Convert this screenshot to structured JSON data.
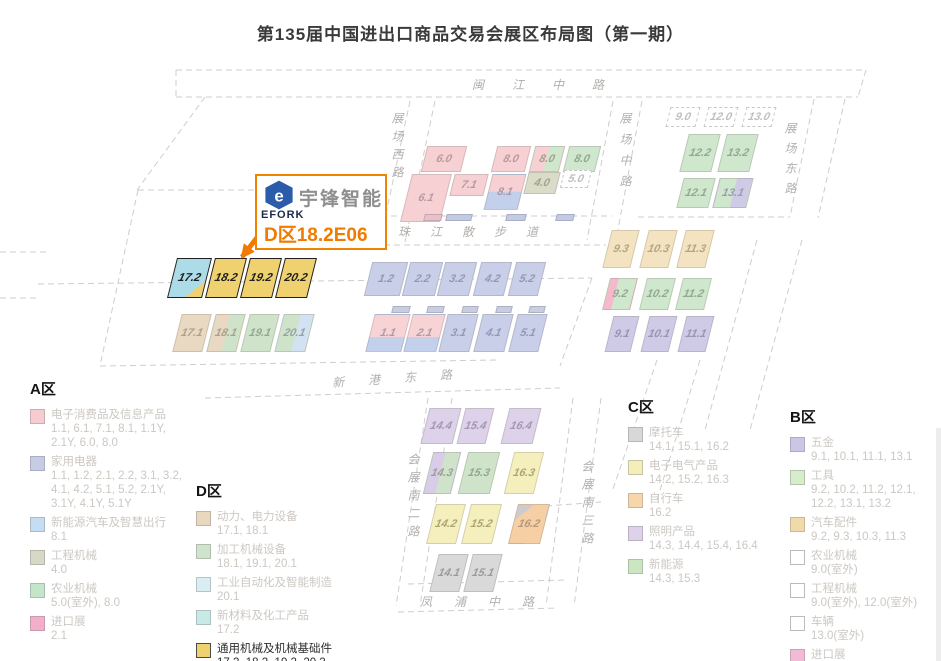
{
  "title": "第135届中国进出口商品交易会展区布局图（第一期）",
  "colors": {
    "accent_orange": "#f08300",
    "booth_text_orange": "#f07b00",
    "efork_blue": "#2a5caa",
    "highlight_yellow": "#f0d170",
    "highlight_cyan": "#abdce8",
    "dashed_road_gray": "#cdcdcd"
  },
  "callout": {
    "brand": "宇锋智能",
    "brand_sub": "EFORK",
    "booth": "D区18.2E06"
  },
  "roads": {
    "minjiang": "闽江中路",
    "west": "展场西路",
    "mid": "展场中路",
    "east": "展场东路",
    "zhujiang": "珠江散步道",
    "xingang": "新港东路",
    "south2": "会展南二路",
    "south3": "会展南三路",
    "fengpu": "凤浦中路"
  },
  "halls": {
    "h1_1": "1.1",
    "h1_2": "1.2",
    "h2_1": "2.1",
    "h2_2": "2.2",
    "h3_1": "3.1",
    "h3_2": "3.2",
    "h4_0": "4.0",
    "h4_1": "4.1",
    "h4_2": "4.2",
    "h5_0": "5.0",
    "h5_1": "5.1",
    "h5_2": "5.2",
    "h6_0": "6.0",
    "h6_1": "6.1",
    "h7_1": "7.1",
    "h8_0": "8.0",
    "h8_1": "8.1",
    "h9_0": "9.0",
    "h9_1": "9.1",
    "h9_2": "9.2",
    "h9_3": "9.3",
    "h10_1": "10.1",
    "h10_2": "10.2",
    "h10_3": "10.3",
    "h11_1": "11.1",
    "h11_2": "11.2",
    "h11_3": "11.3",
    "h12_0": "12.0",
    "h12_1": "12.1",
    "h12_2": "12.2",
    "h13_0": "13.0",
    "h13_1": "13.1",
    "h13_2": "13.2",
    "h14_1": "14.1",
    "h14_2": "14.2",
    "h14_3": "14.3",
    "h14_4": "14.4",
    "h15_1": "15.1",
    "h15_2": "15.2",
    "h15_3": "15.3",
    "h15_4": "15.4",
    "h16_2": "16.2",
    "h16_3": "16.3",
    "h16_4": "16.4",
    "h17_1": "17.1",
    "h17_2": "17.2",
    "h18_1": "18.1",
    "h18_2": "18.2",
    "h19_1": "19.1",
    "h19_2": "19.2",
    "h20_1": "20.1",
    "h20_2": "20.2"
  },
  "legends": {
    "a": {
      "title": "A区",
      "items": [
        {
          "name": "电子消费品及信息产品",
          "halls": "1.1, 6.1, 7.1, 8.1, 1.1Y, 2.1Y, 6.0, 8.0",
          "color": "#f6ccd0"
        },
        {
          "name": "家用电器",
          "halls": "1.1, 1.2, 2.1, 2.2, 3.1, 3.2, 4.1, 4.2, 5.1, 5.2, 2.1Y, 3.1Y, 4.1Y, 5.1Y",
          "color": "#c6cbe6"
        },
        {
          "name": "新能源汽车及智慧出行",
          "halls": "8.1",
          "color": "#c5ddf2"
        },
        {
          "name": "工程机械",
          "halls": "4.0",
          "color": "#d8d8c6"
        },
        {
          "name": "农业机械",
          "halls": "5.0(室外), 8.0",
          "color": "#c3e6ca"
        },
        {
          "name": "进口展",
          "halls": "2.1",
          "color": "#f3aecb"
        }
      ]
    },
    "d": {
      "title": "D区",
      "items": [
        {
          "name": "动力、电力设备",
          "halls": "17.1, 18.1",
          "color": "#e9d8be"
        },
        {
          "name": "加工机械设备",
          "halls": "18.1, 19.1, 20.1",
          "color": "#cfe4cd"
        },
        {
          "name": "工业自动化及智能制造",
          "halls": "20.1",
          "color": "#d8eef2"
        },
        {
          "name": "新材料及化工产品",
          "halls": "17.2",
          "color": "#c9e9e9"
        },
        {
          "name": "通用机械及机械基础件",
          "halls": "17.2, 18.2, 19.2, 20.2",
          "color": "#f0d170",
          "highlight": true
        }
      ]
    },
    "c": {
      "title": "C区",
      "items": [
        {
          "name": "摩托车",
          "halls": "14.1, 15.1, 16.2",
          "color": "#d8d8d8"
        },
        {
          "name": "电子电气产品",
          "halls": "14.2, 15.2, 16.3",
          "color": "#f4efba"
        },
        {
          "name": "自行车",
          "halls": "16.2",
          "color": "#f7d6aa"
        },
        {
          "name": "照明产品",
          "halls": "14.3, 14.4, 15.4, 16.4",
          "color": "#ded2ea"
        },
        {
          "name": "新能源",
          "halls": "14.3, 15.3",
          "color": "#cae7c2"
        }
      ]
    },
    "b": {
      "title": "B区",
      "items": [
        {
          "name": "五金",
          "halls": "9.1, 10.1, 11.1, 13.1",
          "color": "#cbc6e6"
        },
        {
          "name": "工具",
          "halls": "9.2, 10.2, 11.2, 12.1, 12.2, 13.1, 13.2",
          "color": "#d6edca"
        },
        {
          "name": "汽车配件",
          "halls": "9.2, 9.3, 10.3, 11.3",
          "color": "#f1daa9"
        },
        {
          "name": "农业机械",
          "halls": "9.0(室外)",
          "color": "#ffffff"
        },
        {
          "name": "工程机械",
          "halls": "9.0(室外), 12.0(室外)",
          "color": "#ffffff"
        },
        {
          "name": "车辆",
          "halls": "13.0(室外)",
          "color": "#ffffff"
        },
        {
          "name": "进口展",
          "halls": "9.2",
          "color": "#f2bad4"
        }
      ]
    }
  }
}
